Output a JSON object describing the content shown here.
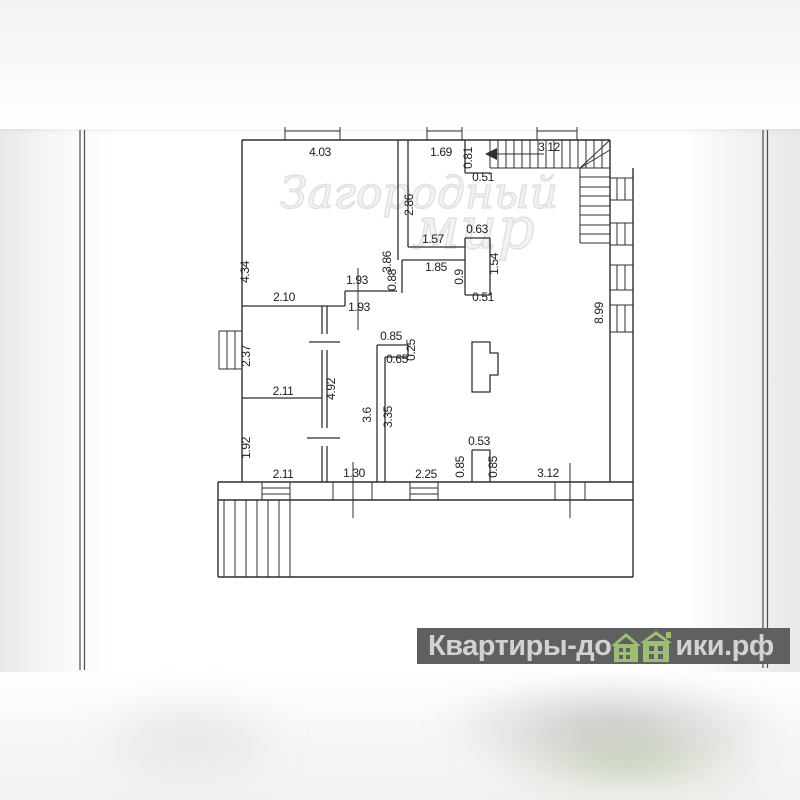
{
  "watermark": {
    "line1": "Загородный",
    "line2": "мир",
    "color": "#d9d9d9"
  },
  "logo": {
    "text_before_icon": "Квартиры-до",
    "text_after_icon": "ики.рф",
    "band_color": "#606060",
    "text_color": "#d2d2d2",
    "house_color": "#9dbd72"
  },
  "plan": {
    "labels": [
      "4.03",
      "1.69",
      "3.12",
      "0.51",
      "1.57",
      "0.63",
      "1.85",
      "0.51",
      "1.93",
      "2.10",
      "1.93",
      "0.85",
      "0.65",
      "2.11",
      "2.11",
      "1.30",
      "2.25",
      "0.53",
      "3.12",
      "4.34",
      "3.86",
      "2.86",
      "0.81",
      "0.88",
      "0.9",
      "1.54",
      "8.99",
      "2.37",
      "1.92",
      "4.92",
      "3.6",
      "3.35",
      "0.25",
      "0.85",
      "0.85"
    ]
  }
}
